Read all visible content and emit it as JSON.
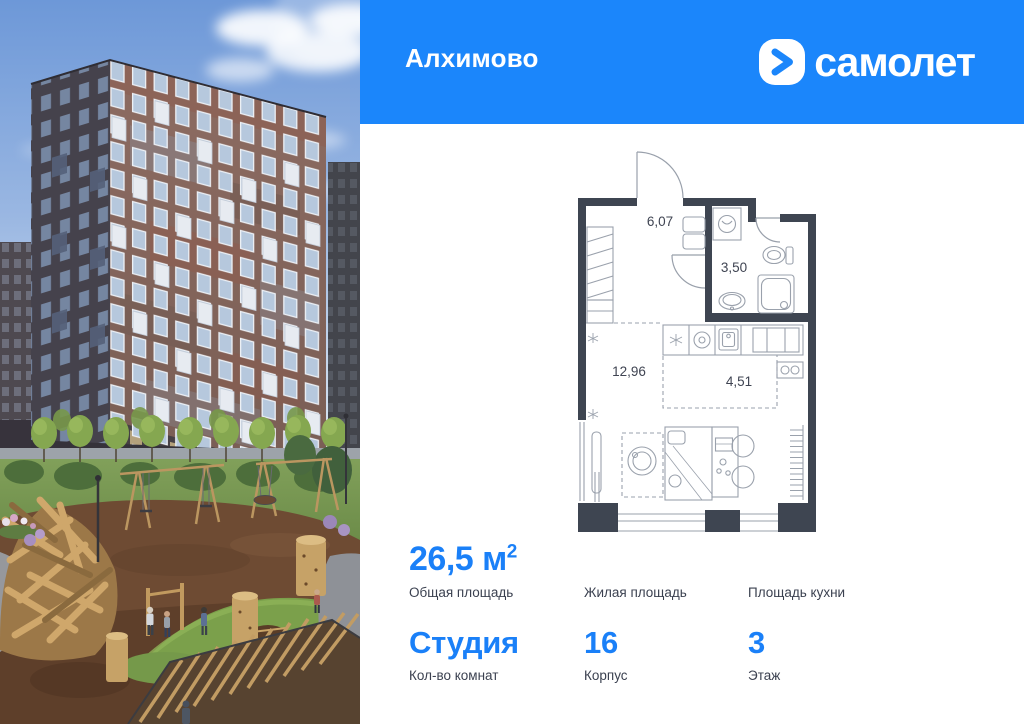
{
  "header": {
    "project_title": "Алхимово",
    "brand": "самолет",
    "bg_color": "#1b86fb"
  },
  "plan": {
    "wall_color": "#3e4551",
    "line_color": "#99a0ab",
    "rooms": [
      {
        "name": "hallway",
        "area": "6,07"
      },
      {
        "name": "bathroom",
        "area": "3,50"
      },
      {
        "name": "living",
        "area": "12,96"
      },
      {
        "name": "kitchen",
        "area": "4,51"
      }
    ]
  },
  "details": {
    "accent_color": "#1a80f8",
    "items": [
      {
        "value": "26,5 м",
        "sup": "2",
        "label": "Общая площадь"
      },
      {
        "value": "",
        "label": "Жилая площадь"
      },
      {
        "value": "",
        "label": "Площадь кухни"
      },
      {
        "value": "Студия",
        "label": "Кол-во комнат"
      },
      {
        "value": "16",
        "label": "Корпус"
      },
      {
        "value": "3",
        "label": "Этаж"
      }
    ]
  },
  "photo_palette": {
    "sky_top": "#6d98d8",
    "sky_bottom": "#dde7f3",
    "facade_left": "#45424c",
    "facade_right": "#87675e",
    "grass": "#7d9b55",
    "mulch": "#6e4b33",
    "wood": "#cfa76b"
  }
}
